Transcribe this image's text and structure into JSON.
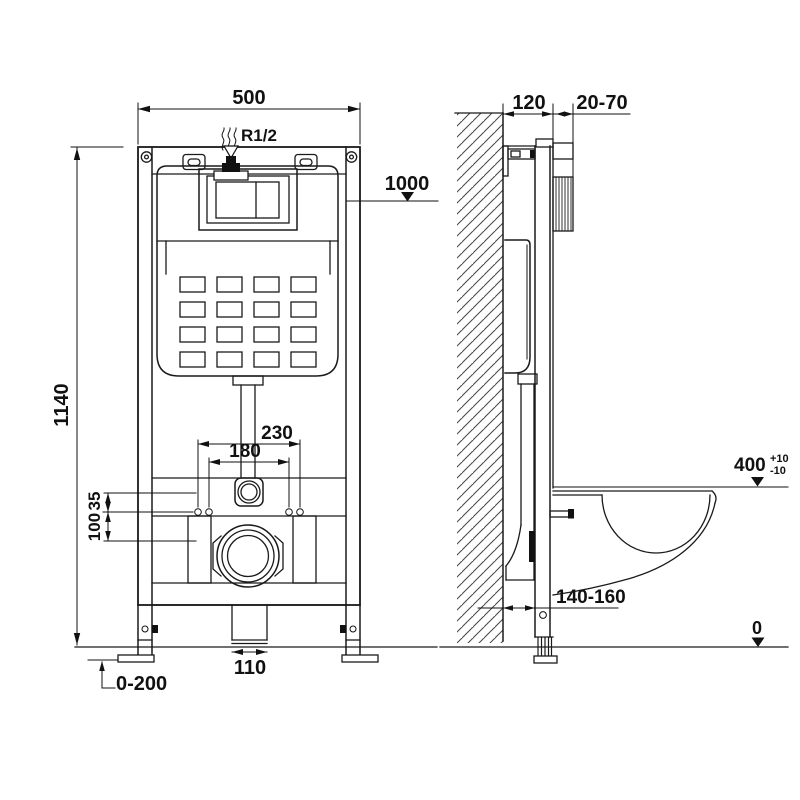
{
  "drawing": {
    "type": "technical-installation-diagram",
    "subject": "concealed-cistern-wall-frame",
    "colors": {
      "line": "#1a1a1a",
      "background": "#ffffff"
    },
    "front_view": {
      "width": "500",
      "height": "1140",
      "inlet": "R1/2",
      "actuation_height": "1000",
      "fixing_width_outer": "230",
      "fixing_width_inner": "180",
      "offset_small": "35",
      "offset_large": "100",
      "outlet_pipe_width": "110",
      "leg_adjustment": "0-200"
    },
    "side_view": {
      "frame_depth": "120",
      "wall_finish_range": "20-70",
      "bowl_height": "400",
      "bowl_height_tol_plus": "+10",
      "bowl_height_tol_minus": "-10",
      "outlet_distance": "140-160",
      "floor_level": "0"
    }
  }
}
